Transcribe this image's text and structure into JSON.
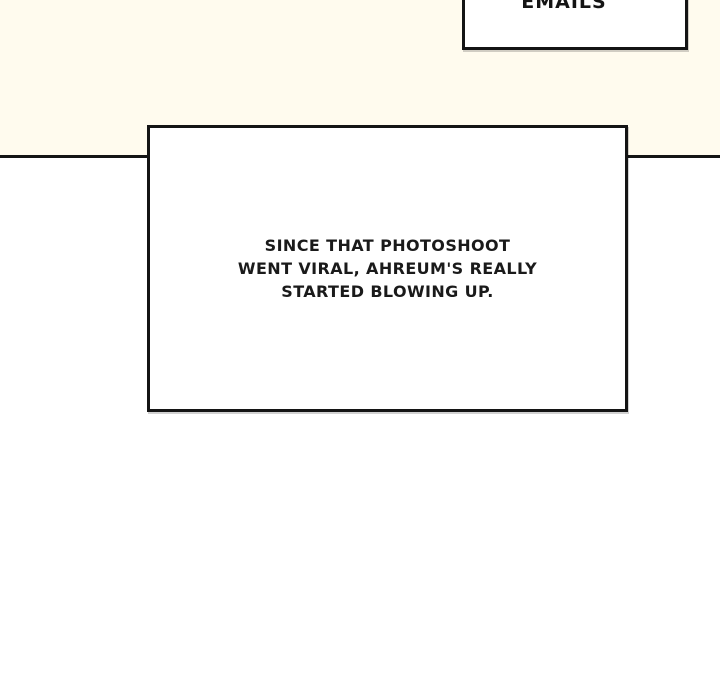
{
  "page": {
    "colors": {
      "panel_cream": "#FFFBEE",
      "panel_white": "#FFFFFF",
      "ink_black": "#141414",
      "caption_fill": "#FFFFFF"
    }
  },
  "top_caption": {
    "text": "EMAILS"
  },
  "main_caption": {
    "lines": [
      "SINCE THAT PHOTOSHOOT",
      "WENT VIRAL, AHREUM'S REALLY",
      "STARTED BLOWING UP."
    ]
  }
}
